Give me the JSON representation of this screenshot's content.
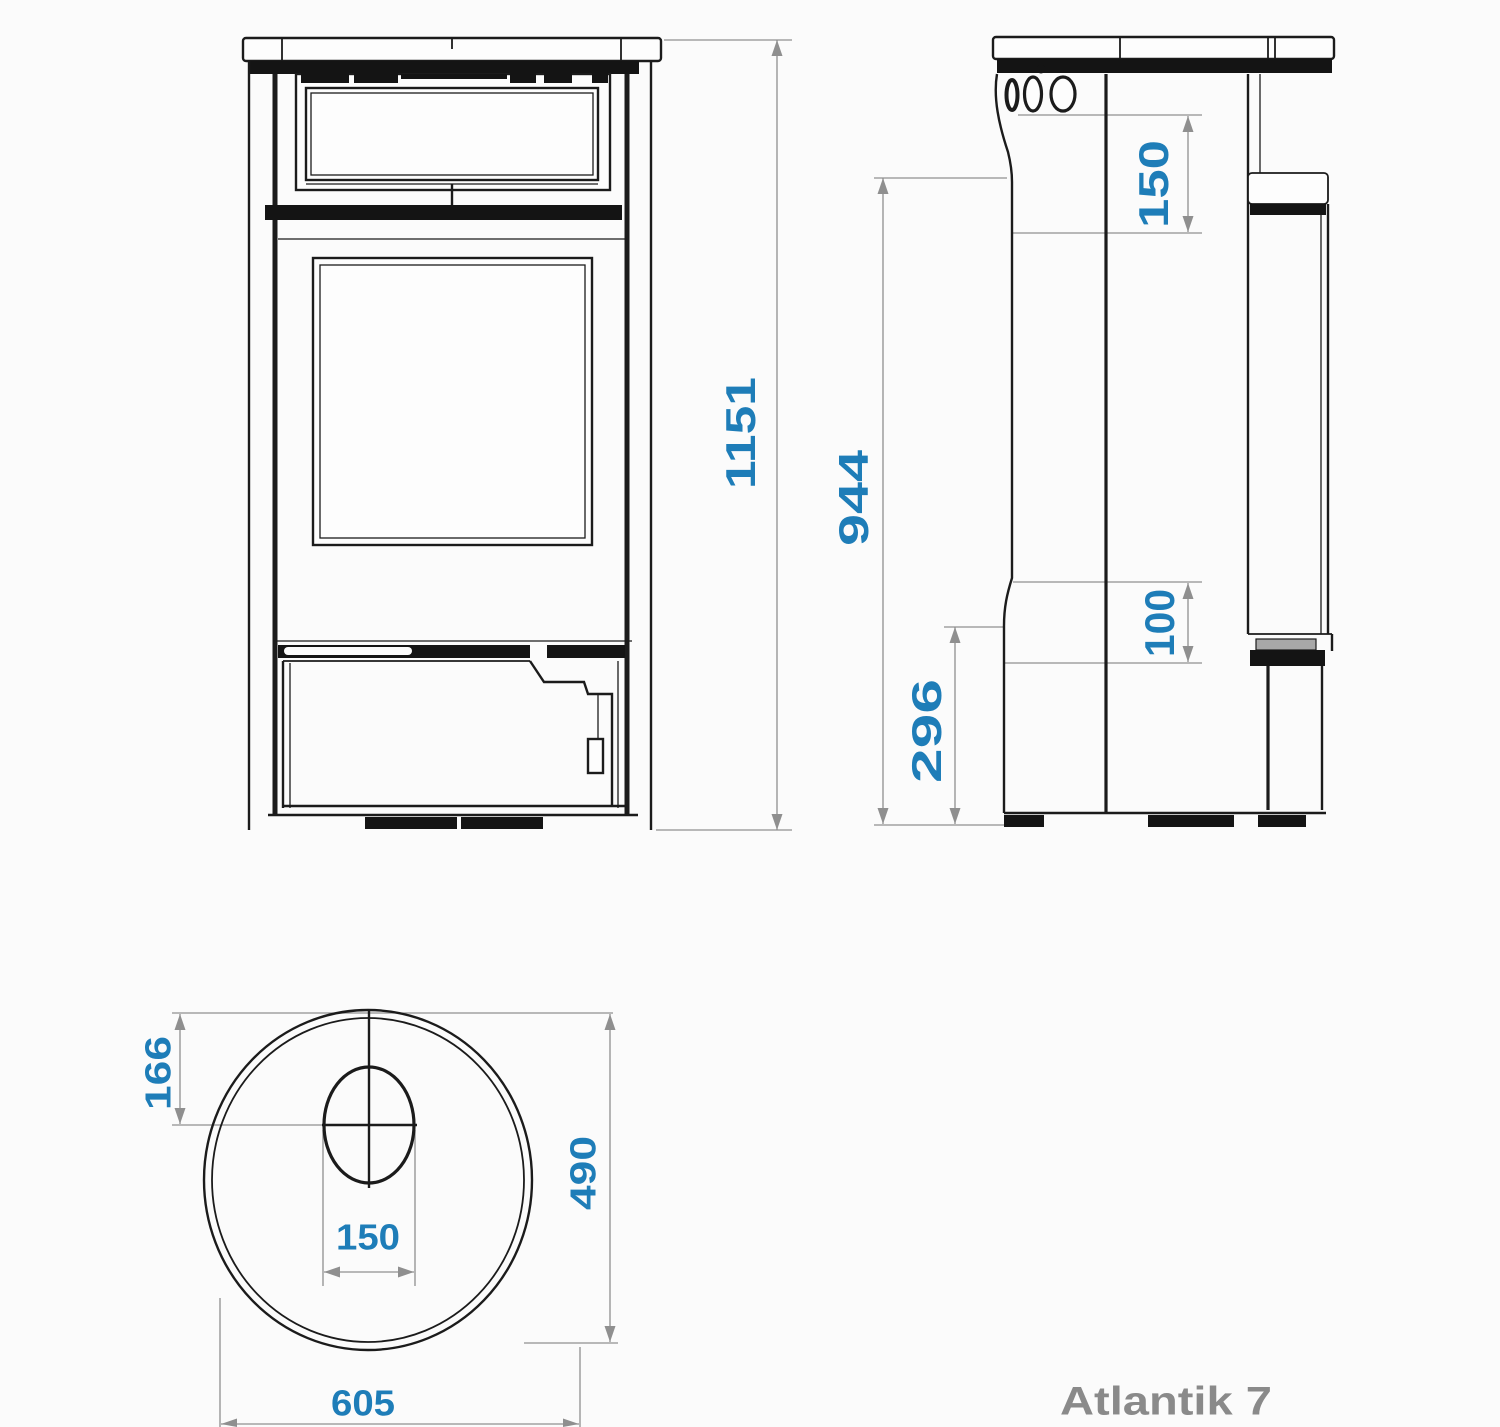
{
  "product_label": "Atlantik 7",
  "views": {
    "front": {
      "title": "front elevation of stove",
      "dims": {
        "overall_height": "1151"
      }
    },
    "side": {
      "title": "side elevation of stove",
      "dims": {
        "flue_height_offset": "150",
        "rear_outlet_height": "944",
        "rear_connection_size": "100",
        "lower_connection_height": "296"
      }
    },
    "top": {
      "title": "top plan view of stove",
      "dims": {
        "flue_center_from_back": "166",
        "depth": "490",
        "flue_diameter": "150",
        "width": "605"
      }
    }
  },
  "colors": {
    "dimension_text": "#1e7db8",
    "dimension_line": "#8f8f8f",
    "drawing_line": "#1b1b1b",
    "product_label_color": "#8a8a8a",
    "paper": "#fbfbfb"
  }
}
